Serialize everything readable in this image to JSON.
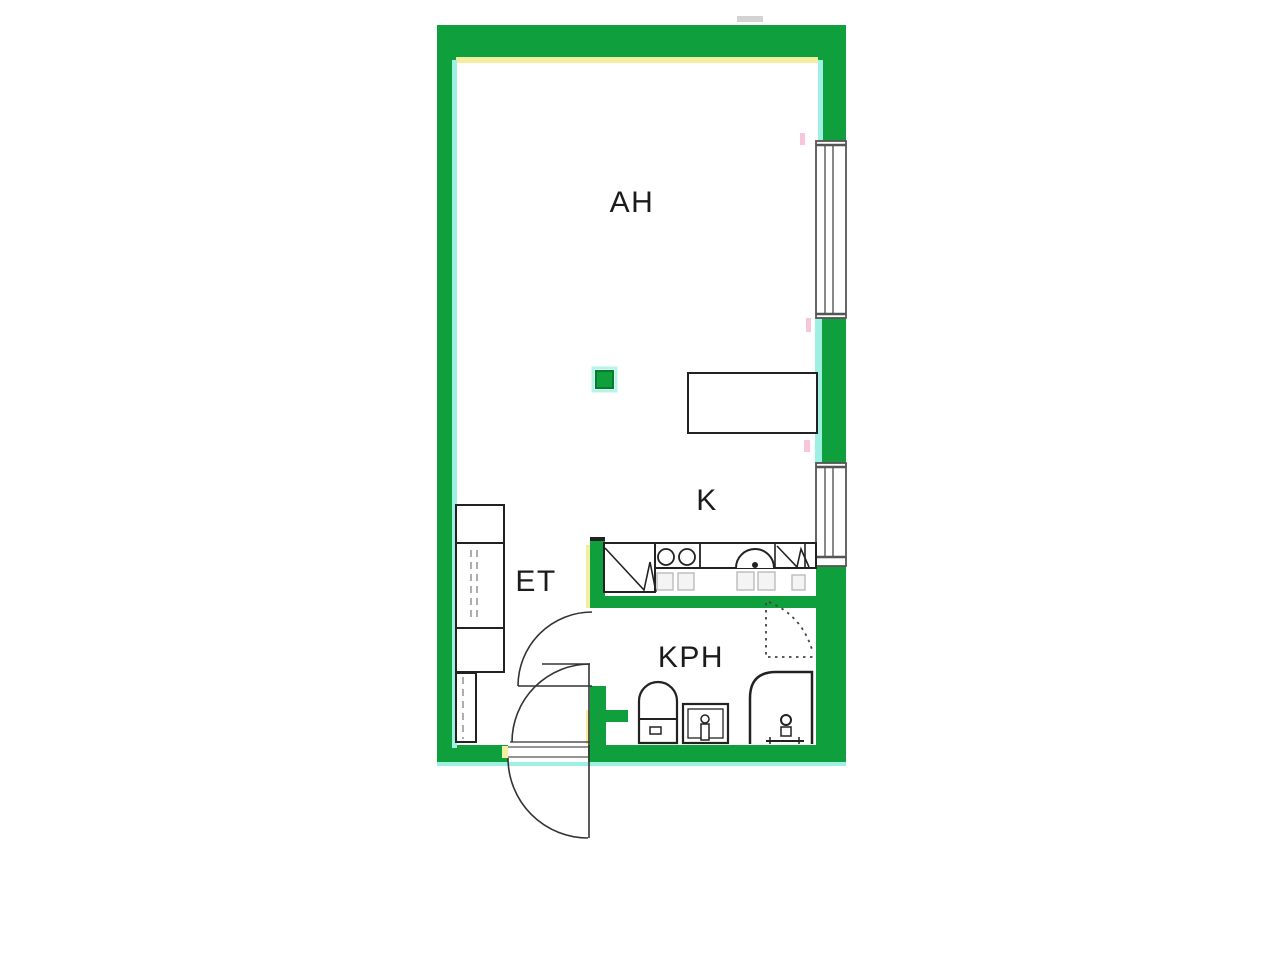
{
  "floor_plan": {
    "rooms": [
      {
        "label": "AH"
      },
      {
        "label": "K"
      },
      {
        "label": "ET"
      },
      {
        "label": "KPH"
      }
    ],
    "colors": {
      "wall_green": "#0f9f3c",
      "accent_cyan": "#9ef0e2",
      "accent_yellow": "#f2efa0",
      "line_black": "#222222"
    },
    "fixtures": [
      "wardrobe-closets",
      "refrigerator",
      "stove-burners",
      "kitchen-sink",
      "dishwasher-appliance",
      "dining-table",
      "support-column",
      "window-upper",
      "window-lower",
      "toilet",
      "washbasin",
      "shower",
      "shower-slope-marking",
      "entrance-door-swing",
      "bathroom-door-swing"
    ]
  }
}
